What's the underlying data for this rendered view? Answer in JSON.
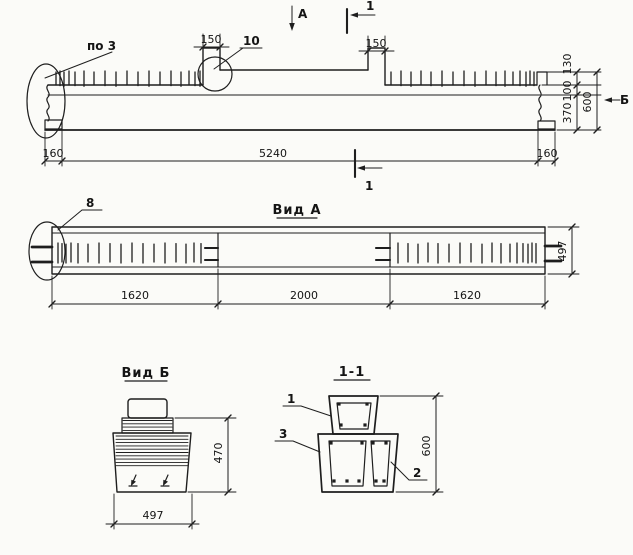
{
  "drawing": {
    "ink_color": "#1e1e1e",
    "paper_color": "#fbfbf8",
    "elevation": {
      "callout_po3": "по 3",
      "callout_10": "10",
      "view_arrow_a": "А",
      "section_label_top": "1",
      "section_label_bottom": "1",
      "dim_150_left": "150",
      "dim_150_right": "150",
      "dim_130": "130",
      "dim_100": "100",
      "dim_370": "370",
      "dim_600": "600",
      "view_arrow_b": "Б",
      "dim_160_left": "160",
      "dim_5240": "5240",
      "dim_160_right": "160"
    },
    "view_a": {
      "title": "Вид А",
      "callout_8": "8",
      "dim_1620_left": "1620",
      "dim_2000": "2000",
      "dim_1620_right": "1620",
      "dim_497": "497"
    },
    "view_b": {
      "title": "Вид Б",
      "dim_470": "470",
      "dim_497": "497"
    },
    "section_1_1": {
      "title": "1-1",
      "pos_1": "1",
      "pos_3": "3",
      "pos_2": "2",
      "dim_600": "600"
    }
  }
}
